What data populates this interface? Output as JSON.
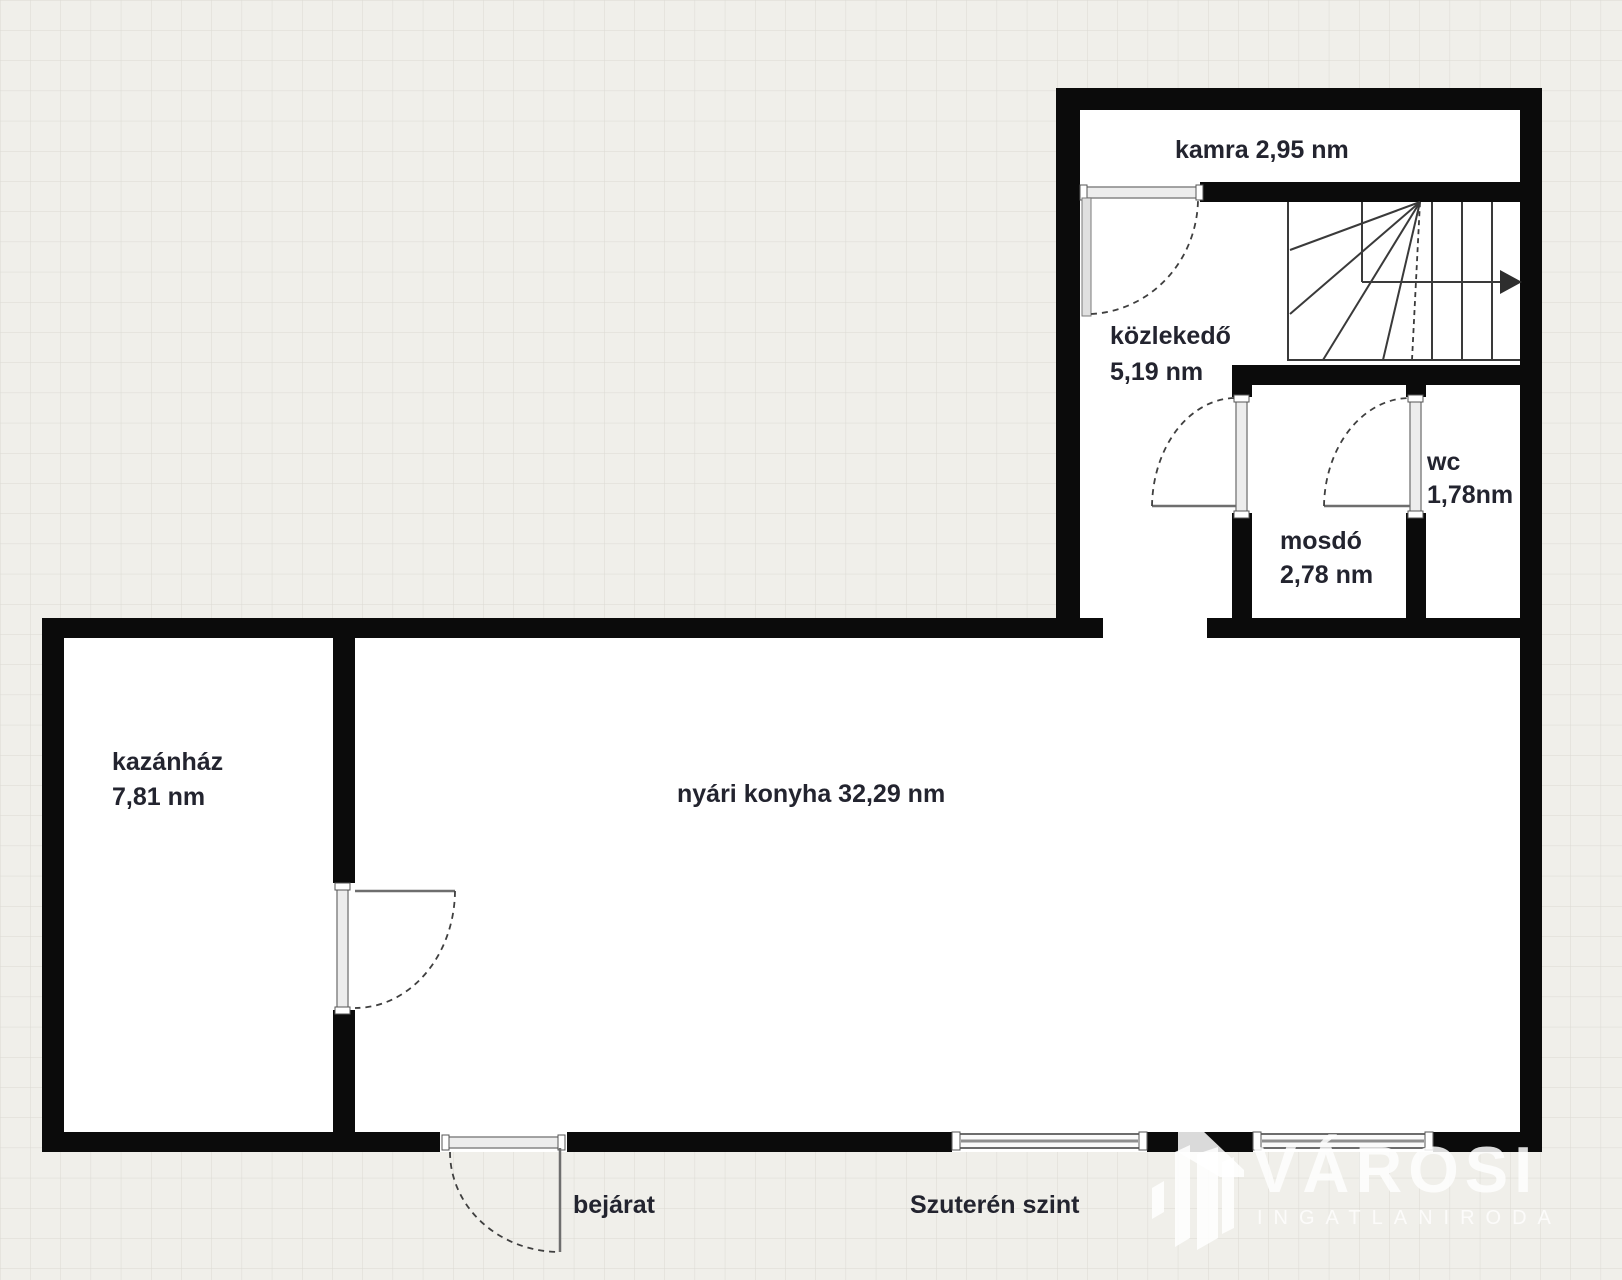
{
  "plan": {
    "level_label": "Szuterén szint",
    "entrance_label": "bejárat",
    "rooms": [
      {
        "id": "kamra",
        "label": "kamra 2,95 nm"
      },
      {
        "id": "kozlekedo",
        "name": "közlekedő",
        "area": "5,19 nm"
      },
      {
        "id": "wc",
        "name": "wc",
        "area": "1,78nm"
      },
      {
        "id": "mosdo",
        "name": "mosdó",
        "area": "2,78 nm"
      },
      {
        "id": "kazanhaz",
        "name": "kazánház",
        "area": "7,81 nm"
      },
      {
        "id": "nyari_konyha",
        "label": "nyári konyha 32,29 nm"
      }
    ]
  },
  "watermark": {
    "brand": "VÁROSI",
    "tagline": "INGATLANIRODA"
  },
  "colors": {
    "wall": "#0b0b0b",
    "paper": "#f0efea",
    "grid_line": "#dbdad3",
    "room_fill": "#ffffff",
    "label_text": "#23242f",
    "watermark": "#ffffff"
  }
}
